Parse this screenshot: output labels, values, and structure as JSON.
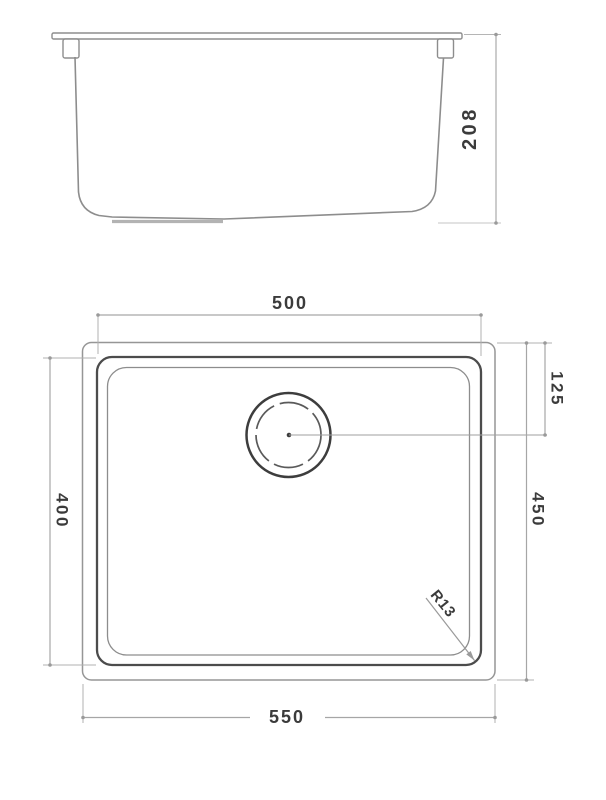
{
  "side_view": {
    "height_label": "208"
  },
  "plan_view": {
    "bowl_length_label": "500",
    "overall_length_label": "550",
    "bowl_width_label": "400",
    "overall_width_label": "450",
    "drain_offset_label": "125",
    "corner_radius_label": "R13"
  },
  "colors": {
    "background": "#ffffff",
    "profile_line": "#8d8d8d",
    "bowl_outline": "#4c4c4c",
    "dimension_line": "#a6a6a6",
    "text": "#3b3b3b"
  }
}
